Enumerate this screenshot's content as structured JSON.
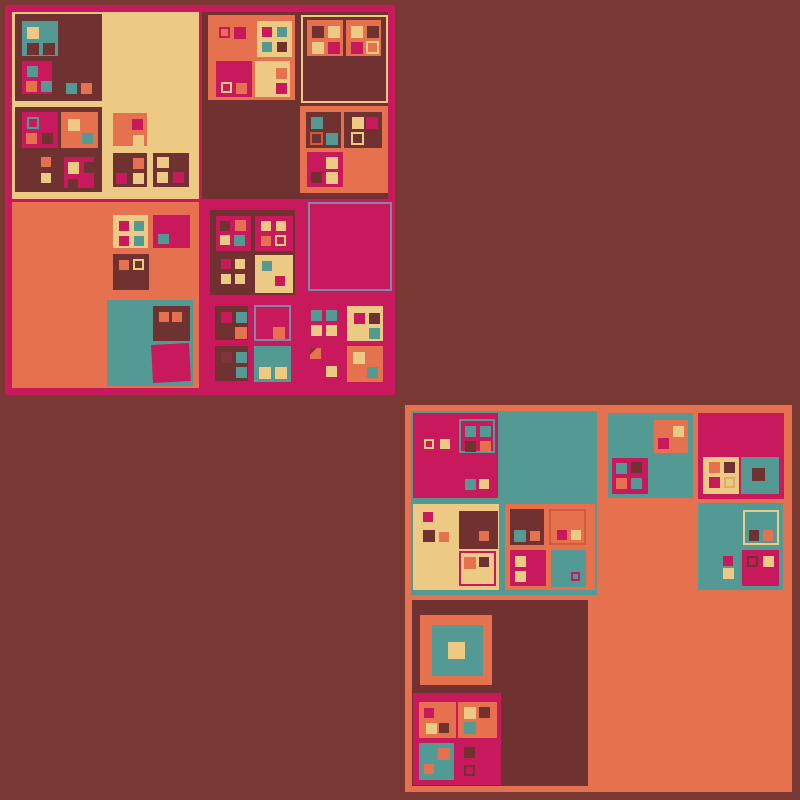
{
  "canvas": {
    "w": 800,
    "h": 800,
    "bg": "#7a3833",
    "description": "abstract generative art of recursive nested squares, no text"
  },
  "palette": {
    "bg": "#7a3833",
    "mag": "#c7195c",
    "org": "#e5714e",
    "crm": "#ecca84",
    "tea": "#549a94",
    "drk": "#6f3231",
    "slate": "#8087a8",
    "oor": "#cf5b3a",
    "dr2": "#7d3537",
    "crmdk": "#d9ae66",
    "slash": "#8c3038"
  },
  "rects": [
    [
      5,
      5,
      390,
      390,
      "mag",
      {
        "n": "block-a-frame"
      }
    ],
    [
      12,
      12,
      187,
      187,
      "crm",
      {
        "n": "quadrant-a1"
      }
    ],
    [
      202,
      12,
      186,
      187,
      "drk",
      {
        "n": "quadrant-a2"
      }
    ],
    [
      12,
      202,
      187,
      186,
      "org",
      {
        "n": "quadrant-a3"
      }
    ],
    [
      15,
      14,
      87,
      87,
      "drk"
    ],
    [
      22,
      21,
      36,
      35,
      "tea"
    ],
    [
      27,
      27,
      12,
      12,
      "crm"
    ],
    [
      27,
      43,
      12,
      12,
      "drk"
    ],
    [
      43,
      43,
      12,
      12,
      "drk"
    ],
    [
      22,
      61,
      30,
      33,
      "mag"
    ],
    [
      27,
      66,
      11,
      11,
      "tea"
    ],
    [
      26,
      81,
      11,
      11,
      "org"
    ],
    [
      41,
      81,
      11,
      11,
      "tea"
    ],
    [
      66,
      83,
      11,
      11,
      "tea"
    ],
    [
      81,
      83,
      11,
      11,
      "org"
    ],
    [
      15,
      107,
      87,
      85,
      "drk"
    ],
    [
      22,
      112,
      36,
      36,
      "mag"
    ],
    [
      27,
      117,
      12,
      12,
      "none",
      {
        "b": "tea"
      }
    ],
    [
      26,
      133,
      11,
      11,
      "org"
    ],
    [
      42,
      133,
      11,
      11,
      "drk"
    ],
    [
      61,
      112,
      37,
      36,
      "org"
    ],
    [
      68,
      119,
      12,
      12,
      "crm"
    ],
    [
      82,
      133,
      11,
      11,
      "tea"
    ],
    [
      41,
      157,
      10,
      10,
      "org"
    ],
    [
      41,
      173,
      10,
      10,
      "crm"
    ],
    [
      60,
      152,
      38,
      39,
      "drk"
    ],
    [
      64,
      157,
      30,
      31,
      "mag"
    ],
    [
      68,
      162,
      11,
      12,
      "crm"
    ],
    [
      84,
      162,
      11,
      11,
      "drk"
    ],
    [
      68,
      179,
      10,
      10,
      "drk"
    ],
    [
      113,
      113,
      34,
      33,
      "org"
    ],
    [
      132,
      119,
      11,
      11,
      "mag"
    ],
    [
      133,
      135,
      11,
      11,
      "crm"
    ],
    [
      113,
      153,
      34,
      34,
      "drk"
    ],
    [
      133,
      158,
      11,
      11,
      "org"
    ],
    [
      116,
      173,
      11,
      11,
      "mag"
    ],
    [
      133,
      173,
      11,
      11,
      "crm"
    ],
    [
      153,
      153,
      36,
      34,
      "drk"
    ],
    [
      157,
      157,
      12,
      11,
      "crm"
    ],
    [
      157,
      172,
      11,
      11,
      "crm"
    ],
    [
      173,
      172,
      11,
      11,
      "mag"
    ],
    [
      208,
      15,
      87,
      85,
      "org"
    ],
    [
      219,
      27,
      11,
      11,
      "none",
      {
        "b": "mag"
      }
    ],
    [
      234,
      27,
      12,
      12,
      "mag"
    ],
    [
      257,
      21,
      35,
      36,
      "crm"
    ],
    [
      262,
      27,
      10,
      10,
      "mag"
    ],
    [
      277,
      27,
      10,
      10,
      "tea"
    ],
    [
      262,
      42,
      10,
      10,
      "tea"
    ],
    [
      277,
      42,
      10,
      10,
      "drk"
    ],
    [
      216,
      61,
      36,
      36,
      "mag"
    ],
    [
      221,
      82,
      11,
      11,
      "none",
      {
        "b": "crm"
      }
    ],
    [
      236,
      83,
      11,
      11,
      "org"
    ],
    [
      255,
      61,
      35,
      36,
      "crm"
    ],
    [
      276,
      68,
      11,
      11,
      "org"
    ],
    [
      276,
      83,
      11,
      11,
      "mag"
    ],
    [
      301,
      15,
      87,
      88,
      "drk",
      {
        "b": "crm"
      }
    ],
    [
      307,
      20,
      36,
      36,
      "org"
    ],
    [
      312,
      26,
      12,
      12,
      "drk"
    ],
    [
      328,
      26,
      12,
      12,
      "crm"
    ],
    [
      312,
      42,
      12,
      12,
      "crm"
    ],
    [
      328,
      42,
      12,
      12,
      "mag"
    ],
    [
      346,
      20,
      35,
      36,
      "org"
    ],
    [
      351,
      26,
      12,
      12,
      "crm"
    ],
    [
      367,
      26,
      12,
      12,
      "drk"
    ],
    [
      351,
      42,
      12,
      12,
      "mag"
    ],
    [
      366,
      41,
      13,
      13,
      "none",
      {
        "b": "crm"
      }
    ],
    [
      300,
      106,
      88,
      87,
      "org"
    ],
    [
      306,
      112,
      35,
      36,
      "drk"
    ],
    [
      311,
      117,
      12,
      12,
      "tea"
    ],
    [
      310,
      132,
      13,
      13,
      "none",
      {
        "b": "oor"
      }
    ],
    [
      326,
      133,
      12,
      12,
      "tea"
    ],
    [
      344,
      112,
      38,
      36,
      "drk"
    ],
    [
      352,
      117,
      12,
      12,
      "crm"
    ],
    [
      366,
      117,
      12,
      12,
      "mag"
    ],
    [
      351,
      132,
      13,
      13,
      "none",
      {
        "b": "crm"
      }
    ],
    [
      307,
      152,
      36,
      35,
      "mag"
    ],
    [
      326,
      157,
      12,
      12,
      "crm"
    ],
    [
      311,
      172,
      11,
      11,
      "drk"
    ],
    [
      326,
      172,
      12,
      12,
      "crm"
    ],
    [
      113,
      215,
      35,
      33,
      "crm"
    ],
    [
      119,
      221,
      10,
      10,
      "mag"
    ],
    [
      134,
      221,
      10,
      10,
      "tea"
    ],
    [
      119,
      236,
      10,
      10,
      "mag"
    ],
    [
      134,
      236,
      10,
      10,
      "tea"
    ],
    [
      153,
      215,
      37,
      33,
      "mag"
    ],
    [
      158,
      234,
      11,
      10,
      "tea"
    ],
    [
      113,
      254,
      36,
      36,
      "drk"
    ],
    [
      119,
      260,
      10,
      10,
      "org"
    ],
    [
      133,
      259,
      11,
      11,
      "none",
      {
        "b": "crm"
      }
    ],
    [
      107,
      300,
      86,
      86,
      "tea"
    ],
    [
      153,
      306,
      37,
      35,
      "drk"
    ],
    [
      159,
      312,
      10,
      10,
      "org"
    ],
    [
      172,
      312,
      10,
      10,
      "org"
    ],
    [
      152,
      344,
      38,
      38,
      "mag",
      {
        "r": -3
      }
    ],
    [
      308,
      202,
      84,
      89,
      "none",
      {
        "b": "slate",
        "n": "outline-square"
      }
    ],
    [
      210,
      210,
      85,
      85,
      "drk"
    ],
    [
      216,
      216,
      35,
      35,
      "mag"
    ],
    [
      220,
      221,
      10,
      10,
      "drk"
    ],
    [
      235,
      220,
      11,
      11,
      "org"
    ],
    [
      220,
      235,
      10,
      10,
      "crm"
    ],
    [
      234,
      235,
      11,
      11,
      "tea"
    ],
    [
      255,
      216,
      38,
      35,
      "mag"
    ],
    [
      261,
      221,
      10,
      10,
      "crm"
    ],
    [
      276,
      221,
      10,
      10,
      "crm"
    ],
    [
      261,
      236,
      10,
      10,
      "org"
    ],
    [
      275,
      235,
      11,
      11,
      "none",
      {
        "b": "crm"
      }
    ],
    [
      221,
      259,
      10,
      10,
      "mag"
    ],
    [
      235,
      259,
      10,
      10,
      "crm"
    ],
    [
      221,
      274,
      10,
      10,
      "crm"
    ],
    [
      235,
      274,
      10,
      10,
      "crm"
    ],
    [
      255,
      255,
      38,
      38,
      "crm"
    ],
    [
      262,
      261,
      10,
      10,
      "tea"
    ],
    [
      275,
      276,
      10,
      10,
      "mag"
    ],
    [
      215,
      306,
      33,
      34,
      "drk"
    ],
    [
      221,
      312,
      11,
      11,
      "mag"
    ],
    [
      236,
      312,
      11,
      11,
      "tea"
    ],
    [
      235,
      327,
      12,
      12,
      "org"
    ],
    [
      254,
      305,
      37,
      36,
      "mag",
      {
        "b": "slate"
      }
    ],
    [
      273,
      327,
      12,
      12,
      "org"
    ],
    [
      311,
      310,
      11,
      11,
      "tea"
    ],
    [
      326,
      310,
      11,
      11,
      "tea"
    ],
    [
      311,
      325,
      11,
      11,
      "crm"
    ],
    [
      326,
      325,
      11,
      11,
      "crm"
    ],
    [
      347,
      306,
      36,
      35,
      "crm"
    ],
    [
      354,
      313,
      11,
      11,
      "mag"
    ],
    [
      369,
      313,
      11,
      11,
      "drk"
    ],
    [
      369,
      328,
      11,
      11,
      "tea"
    ],
    [
      215,
      346,
      33,
      35,
      "drk"
    ],
    [
      221,
      352,
      11,
      11,
      "dr2"
    ],
    [
      236,
      352,
      11,
      11,
      "tea"
    ],
    [
      236,
      367,
      11,
      11,
      "tea"
    ],
    [
      254,
      346,
      37,
      36,
      "tea"
    ],
    [
      259,
      367,
      12,
      12,
      "crm"
    ],
    [
      275,
      367,
      12,
      12,
      "crm"
    ],
    [
      310,
      348,
      11,
      11,
      "org",
      {
        "s": "slash"
      }
    ],
    [
      326,
      366,
      11,
      11,
      "crm"
    ],
    [
      347,
      346,
      36,
      36,
      "org"
    ],
    [
      353,
      352,
      12,
      12,
      "crm"
    ],
    [
      367,
      367,
      11,
      11,
      "tea"
    ],
    [
      405,
      405,
      387,
      387,
      "org",
      {
        "n": "block-b-frame"
      }
    ],
    [
      411,
      411,
      186,
      184,
      "tea",
      {
        "n": "quadrant-b1"
      }
    ],
    [
      412,
      600,
      176,
      186,
      "drk",
      {
        "n": "quadrant-b3"
      }
    ],
    [
      413,
      413,
      85,
      85,
      "mag"
    ],
    [
      424,
      439,
      10,
      10,
      "none",
      {
        "b": "crm"
      }
    ],
    [
      440,
      439,
      10,
      10,
      "crm"
    ],
    [
      459,
      419,
      36,
      34,
      "mag",
      {
        "b": "tea"
      }
    ],
    [
      465,
      426,
      11,
      11,
      "tea"
    ],
    [
      480,
      426,
      11,
      11,
      "tea"
    ],
    [
      465,
      441,
      11,
      11,
      "drk"
    ],
    [
      480,
      441,
      11,
      11,
      "org"
    ],
    [
      465,
      479,
      11,
      11,
      "tea"
    ],
    [
      479,
      479,
      10,
      10,
      "crm"
    ],
    [
      413,
      504,
      86,
      86,
      "crm"
    ],
    [
      423,
      512,
      10,
      10,
      "mag"
    ],
    [
      423,
      530,
      12,
      12,
      "drk"
    ],
    [
      439,
      532,
      10,
      10,
      "org"
    ],
    [
      459,
      511,
      39,
      38,
      "drk"
    ],
    [
      479,
      531,
      10,
      10,
      "org"
    ],
    [
      459,
      551,
      37,
      35,
      "crm",
      {
        "b": "mag"
      }
    ],
    [
      464,
      557,
      12,
      12,
      "org"
    ],
    [
      479,
      557,
      10,
      10,
      "drk"
    ],
    [
      505,
      504,
      90,
      86,
      "org"
    ],
    [
      510,
      509,
      34,
      36,
      "drk"
    ],
    [
      514,
      530,
      12,
      12,
      "tea"
    ],
    [
      530,
      531,
      10,
      10,
      "org"
    ],
    [
      549,
      509,
      37,
      36,
      "org",
      {
        "b": "oor"
      }
    ],
    [
      557,
      530,
      10,
      10,
      "mag"
    ],
    [
      571,
      530,
      10,
      10,
      "crm"
    ],
    [
      510,
      550,
      36,
      36,
      "mag"
    ],
    [
      515,
      556,
      11,
      11,
      "crm"
    ],
    [
      515,
      571,
      11,
      11,
      "crm"
    ],
    [
      551,
      550,
      35,
      37,
      "tea"
    ],
    [
      571,
      572,
      9,
      9,
      "none",
      {
        "b": "mag"
      }
    ],
    [
      608,
      413,
      85,
      85,
      "tea"
    ],
    [
      654,
      420,
      34,
      33,
      "org"
    ],
    [
      673,
      426,
      11,
      11,
      "crm"
    ],
    [
      658,
      438,
      11,
      11,
      "mag"
    ],
    [
      612,
      458,
      36,
      36,
      "mag"
    ],
    [
      616,
      463,
      11,
      11,
      "tea"
    ],
    [
      631,
      462,
      11,
      11,
      "drk"
    ],
    [
      616,
      478,
      11,
      11,
      "org"
    ],
    [
      631,
      478,
      11,
      11,
      "tea"
    ],
    [
      698,
      413,
      86,
      86,
      "mag"
    ],
    [
      703,
      457,
      36,
      37,
      "crm"
    ],
    [
      709,
      462,
      11,
      11,
      "org"
    ],
    [
      724,
      462,
      11,
      11,
      "drk"
    ],
    [
      709,
      477,
      11,
      11,
      "mag"
    ],
    [
      724,
      477,
      11,
      11,
      "none",
      {
        "b": "crmdk"
      }
    ],
    [
      741,
      457,
      38,
      37,
      "tea"
    ],
    [
      752,
      468,
      13,
      13,
      "drk"
    ],
    [
      698,
      503,
      85,
      87,
      "tea"
    ],
    [
      743,
      510,
      36,
      35,
      "tea",
      {
        "b": "crm"
      }
    ],
    [
      749,
      530,
      10,
      11,
      "drk"
    ],
    [
      763,
      530,
      10,
      11,
      "org"
    ],
    [
      723,
      556,
      10,
      10,
      "mag"
    ],
    [
      723,
      568,
      11,
      11,
      "crm"
    ],
    [
      742,
      550,
      37,
      36,
      "mag"
    ],
    [
      747,
      556,
      11,
      11,
      "mag",
      {
        "b": "drk"
      }
    ],
    [
      763,
      556,
      11,
      11,
      "crm"
    ],
    [
      420,
      615,
      72,
      70,
      "org"
    ],
    [
      432,
      625,
      51,
      51,
      "tea"
    ],
    [
      448,
      642,
      17,
      17,
      "crm"
    ],
    [
      413,
      693,
      88,
      92,
      "mag"
    ],
    [
      419,
      702,
      37,
      36,
      "org"
    ],
    [
      424,
      708,
      10,
      10,
      "mag"
    ],
    [
      426,
      723,
      11,
      11,
      "crm"
    ],
    [
      439,
      723,
      10,
      10,
      "drk"
    ],
    [
      458,
      702,
      39,
      36,
      "org"
    ],
    [
      464,
      707,
      12,
      12,
      "crm"
    ],
    [
      479,
      707,
      11,
      11,
      "drk"
    ],
    [
      464,
      722,
      12,
      12,
      "tea"
    ],
    [
      419,
      743,
      35,
      37,
      "tea"
    ],
    [
      438,
      748,
      12,
      12,
      "org"
    ],
    [
      424,
      764,
      10,
      10,
      "org"
    ],
    [
      464,
      747,
      11,
      11,
      "drk"
    ],
    [
      464,
      765,
      11,
      11,
      "none",
      {
        "b": "drk"
      }
    ]
  ]
}
